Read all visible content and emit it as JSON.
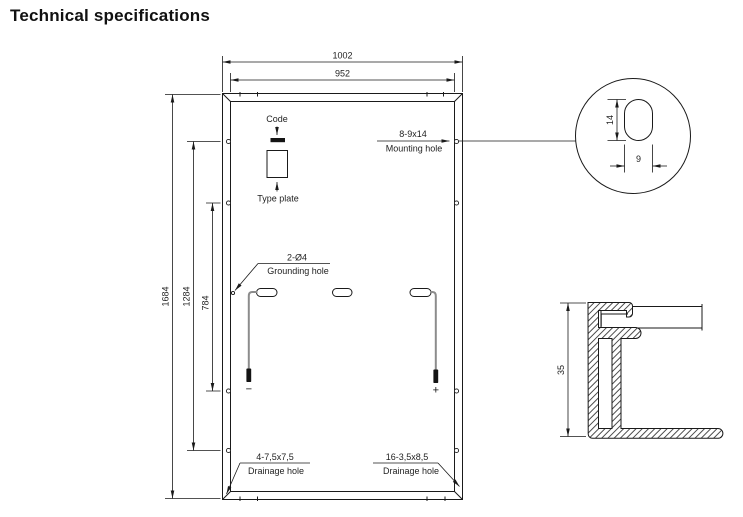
{
  "title": "Technical specifications",
  "panel": {
    "dim_outer_width": "1002",
    "dim_inner_width": "952",
    "dim_outer_height": "1684",
    "dim_mount_span_outer": "1284",
    "dim_mount_span_inner": "784",
    "code": {
      "label": "Code"
    },
    "type_plate": {
      "label": "Type plate"
    },
    "mounting_hole": {
      "size": "8-9x14",
      "label": "Mounting hole"
    },
    "grounding_hole": {
      "size": "2-Ø4",
      "label": "Grounding hole"
    },
    "drainage_hole_left": {
      "size": "4-7,5x7,5",
      "label": "Drainage hole"
    },
    "drainage_hole_right": {
      "size": "16-3,5x8,5",
      "label": "Drainage hole"
    },
    "cable_negative_label": "−",
    "cable_positive_label": "+"
  },
  "mounting_hole_detail": {
    "dim_length": "14",
    "dim_width": "9"
  },
  "frame_section": {
    "dim_height": "35"
  },
  "colors": {
    "line": "#1a1a1a",
    "cable_gray": "#8c8c8c",
    "background": "#ffffff"
  }
}
